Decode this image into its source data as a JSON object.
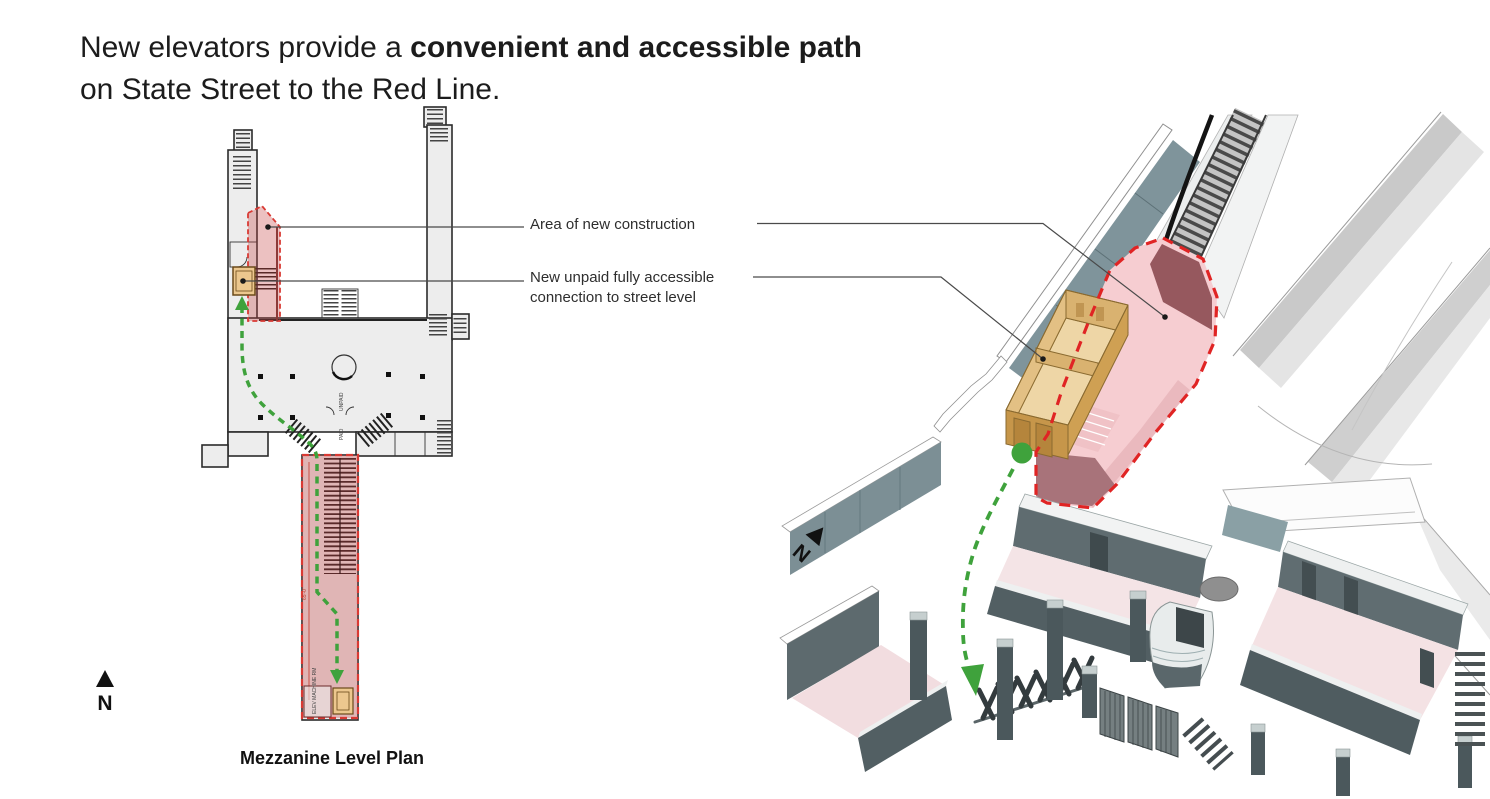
{
  "title": {
    "line1_normal": "New elevators provide a ",
    "line1_bold": "convenient and accessible path",
    "line2": "on State Street to the Red Line."
  },
  "annotations": {
    "area_of_new_construction": "Area of new construction",
    "accessible_connection_line1": "New unpaid fully accessible",
    "accessible_connection_line2": "connection to street level"
  },
  "floor_plan": {
    "caption": "Mezzanine Level Plan",
    "north_label": "N",
    "unpaid_label": "UNPAID",
    "paid_label": "PAID",
    "elev_machine_room_label": "ELEV MACHINE RM",
    "dimension_label": "65'-0\""
  },
  "iso_view": {
    "north_label": "N"
  },
  "colors": {
    "new_construction_outline": "#e02424",
    "new_construction_fill": "#f6cdd1",
    "plan_highlight_fill": "rgba(197,62,62,0.32)",
    "elevator_tan": "#ecc78e",
    "accessible_path_green": "#3fa23c"
  }
}
